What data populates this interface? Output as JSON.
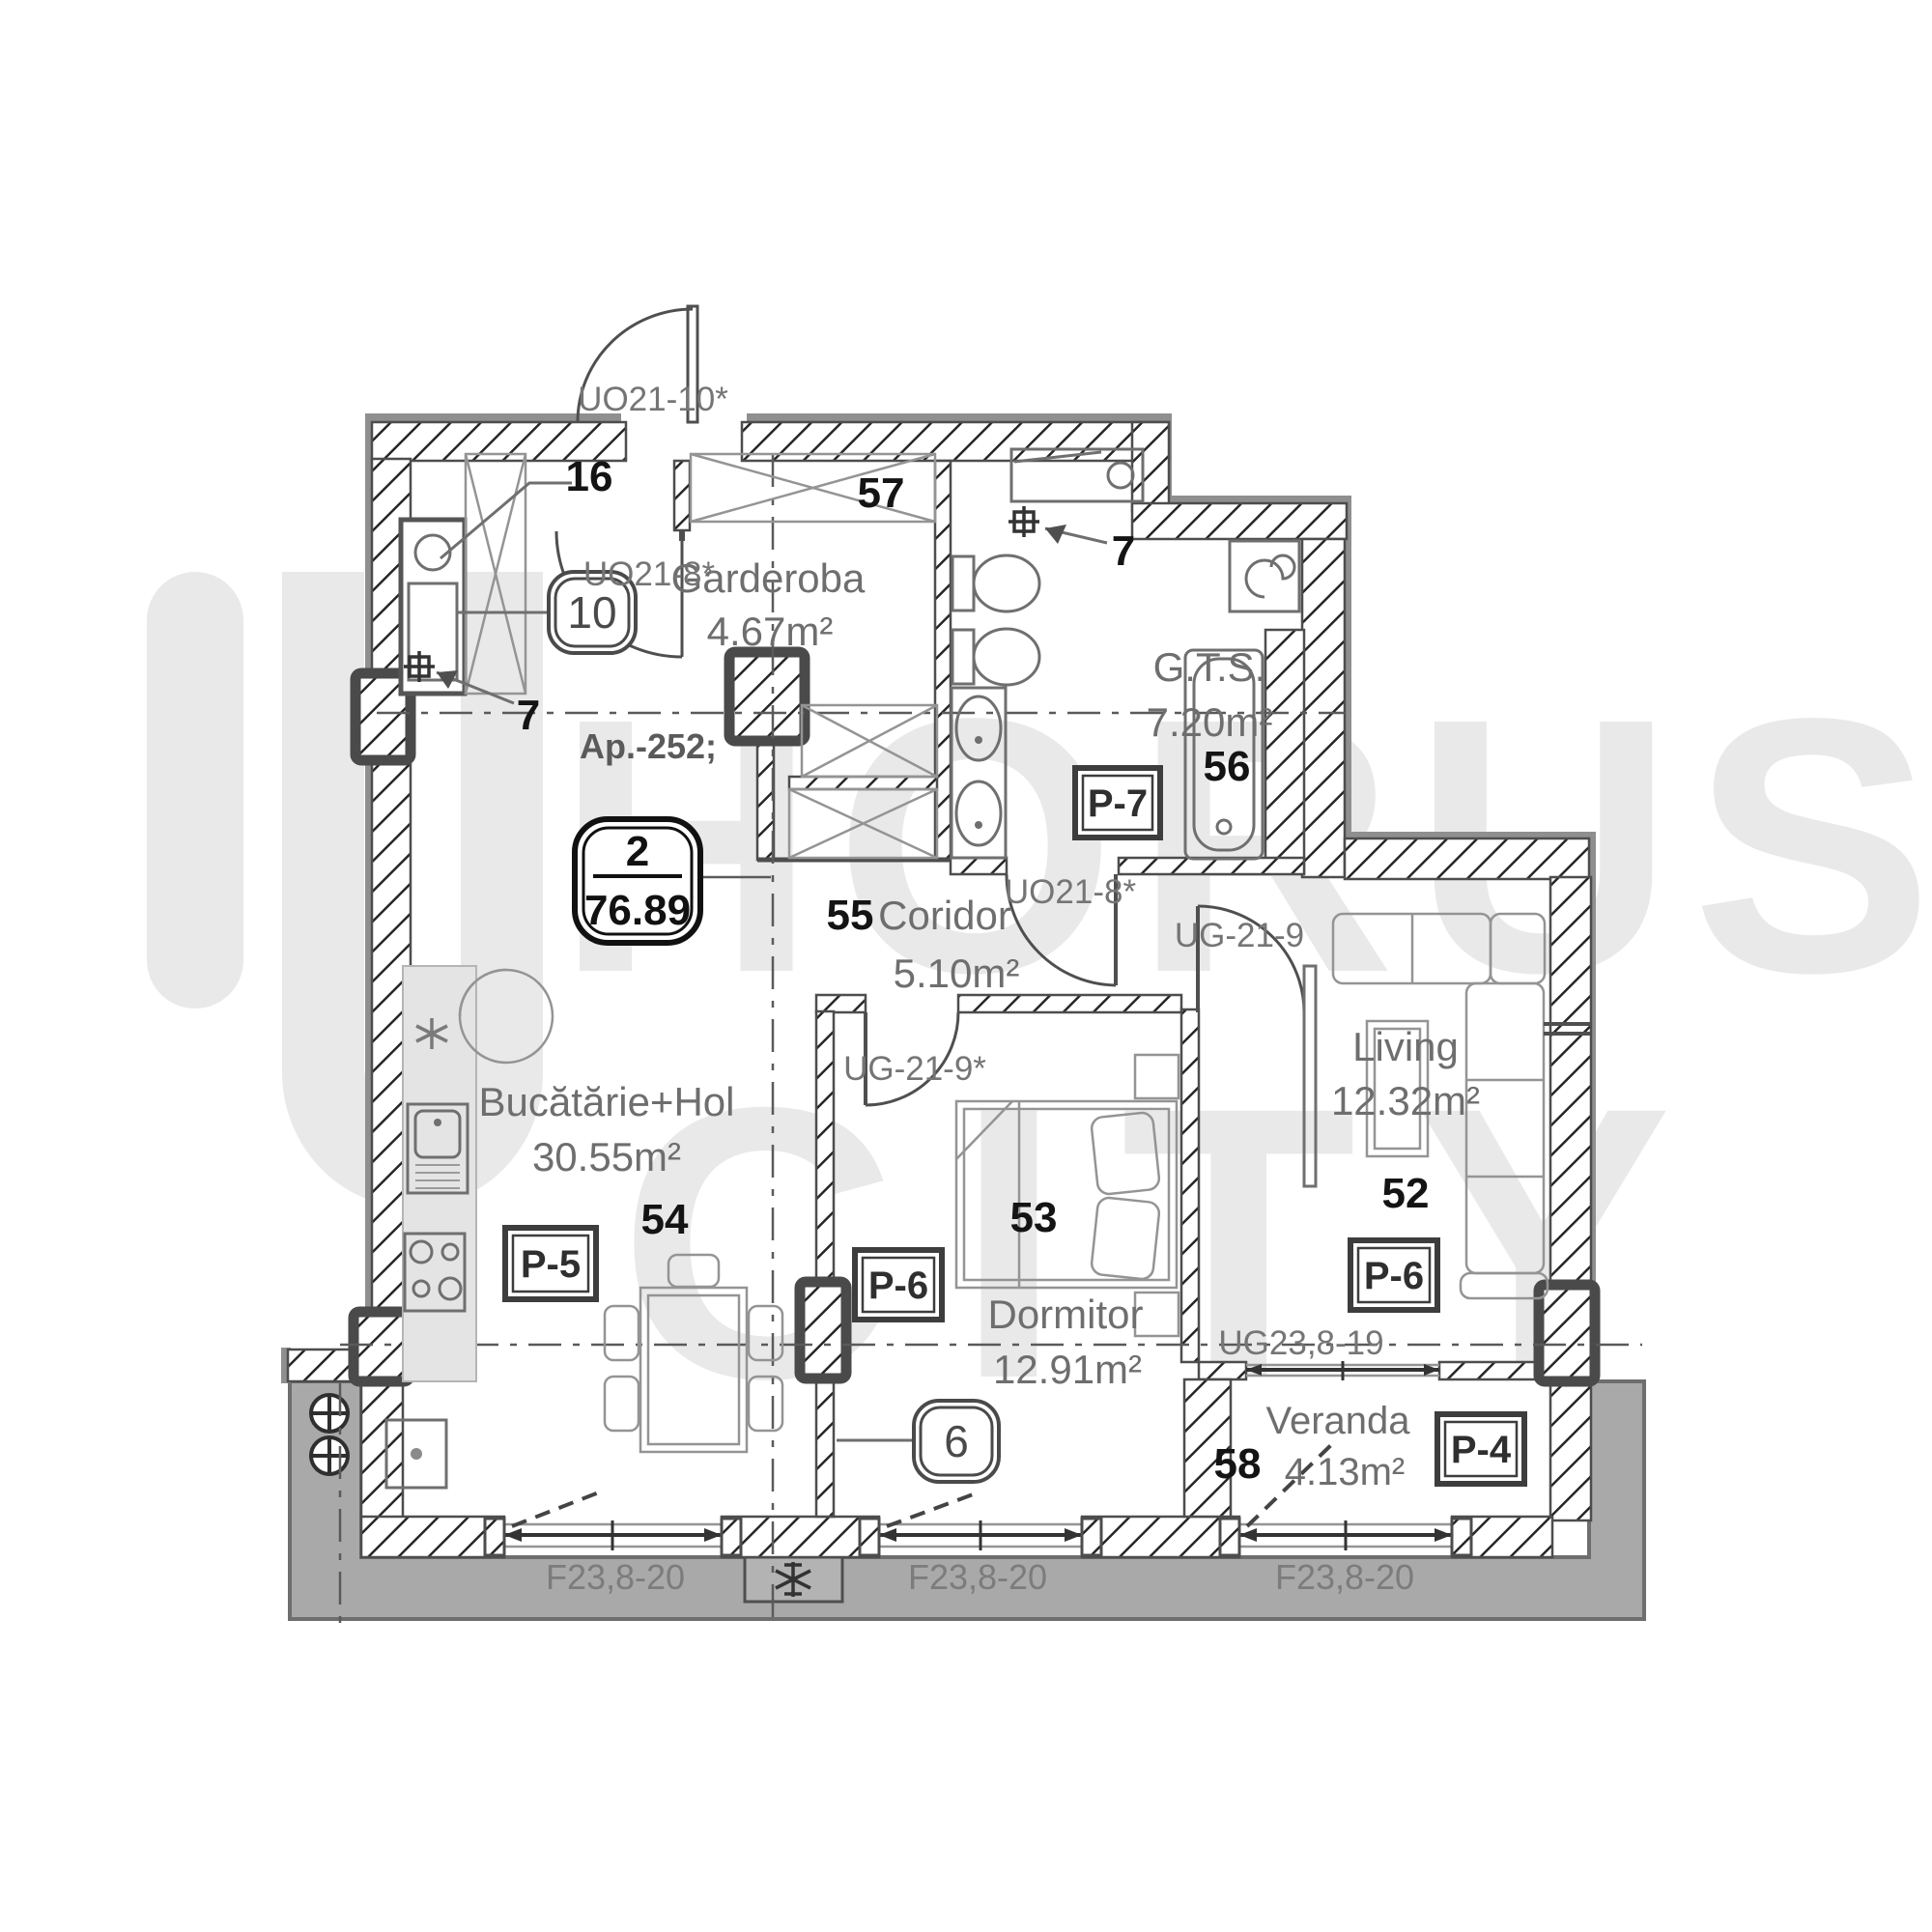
{
  "watermark": {
    "brand_top": "HORUS",
    "brand_bottom": "CITY"
  },
  "apartment": {
    "label": "Ap.-252;",
    "badge_rooms": "2",
    "badge_area": "76.89"
  },
  "rooms": {
    "living": {
      "number": "52",
      "name": "Living",
      "area": "12.32m²",
      "finish": "P-6"
    },
    "dormitor": {
      "number": "53",
      "name": "Dormitor",
      "area": "12.91m²",
      "finish": "P-6"
    },
    "bucatarie": {
      "number": "54",
      "name": "Bucătărie+Hol",
      "area": "30.55m²",
      "finish": "P-5"
    },
    "coridor": {
      "number": "55",
      "name": "Coridor",
      "area": "5.10m²"
    },
    "gts": {
      "number": "56",
      "name": "G.T.S.",
      "area": "7.20m²",
      "finish": "P-7"
    },
    "garderoba": {
      "number": "57",
      "name": "Garderoba",
      "area": "4.67m²"
    },
    "veranda": {
      "number": "58",
      "name": "Veranda",
      "area": "4.13m²",
      "finish": "P-4"
    }
  },
  "doors": {
    "entry": "UO21-10*",
    "garderoba": "UO21-8*",
    "bathroom": "UO21-8*",
    "living": "UG-21-9",
    "dormitor": "UG-21-9*",
    "veranda": "UG23,8-19"
  },
  "windows": [
    {
      "code": "F23,8-20"
    },
    {
      "code": "F23,8-20"
    },
    {
      "code": "F23,8-20"
    }
  ],
  "callouts": {
    "shaft": "16",
    "duct": "10",
    "tap_hall": "7",
    "tap_bath": "7",
    "balcony": "6"
  },
  "colors": {
    "watermark": "#e9e9e9",
    "balcony_fill": "#a9a9a9",
    "wall_outline": "#4d4d4d",
    "outer_band": "#8f8f8f",
    "text_gray": "#6e6e6e",
    "number_black": "#141414"
  }
}
